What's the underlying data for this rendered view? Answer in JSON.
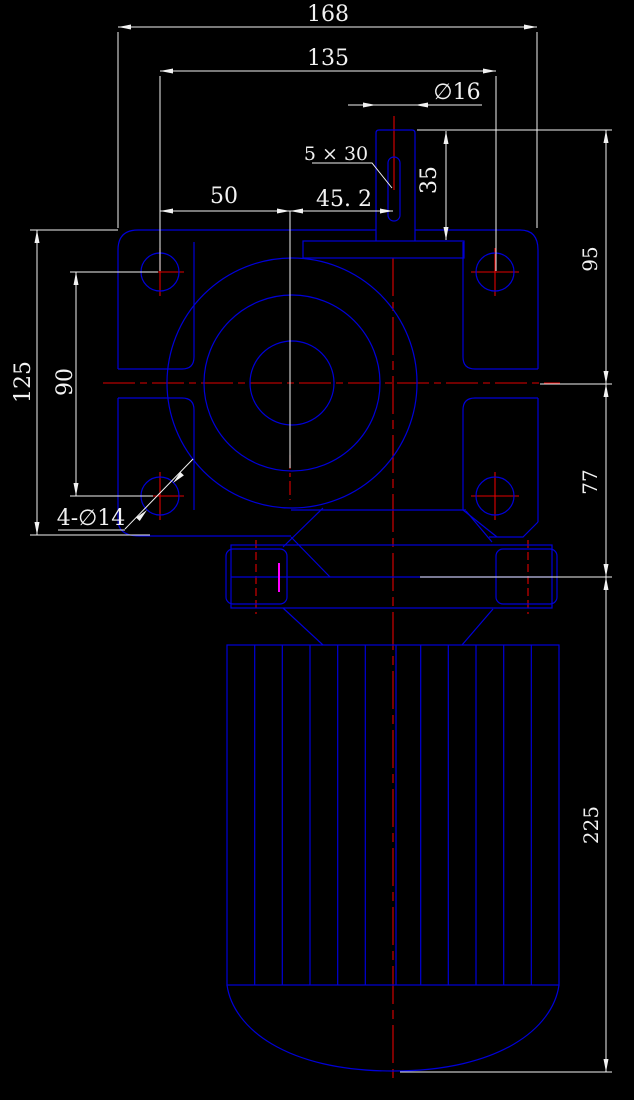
{
  "drawing": {
    "kind": "cad-engineering-drawing",
    "subject": "worm-gear-motor-front-view",
    "colors": {
      "background": "#000000",
      "geometry": "#0000d8",
      "centerline": "#e00000",
      "dimension": "#f2f2f2",
      "highlight": "#ff00ff"
    },
    "dimensions": {
      "overall_width": "168",
      "hole_span_width": "135",
      "shaft_diameter": "∅16",
      "keyway": "5 × 30",
      "center_to_left_holes": "50",
      "center_to_shaft": "45. 2",
      "shaft_length": "35",
      "flange_height": "125",
      "hole_span_height": "90",
      "mounting_holes": "4-∅14",
      "upper_height": "95",
      "mid_height": "77",
      "motor_length": "225"
    }
  }
}
